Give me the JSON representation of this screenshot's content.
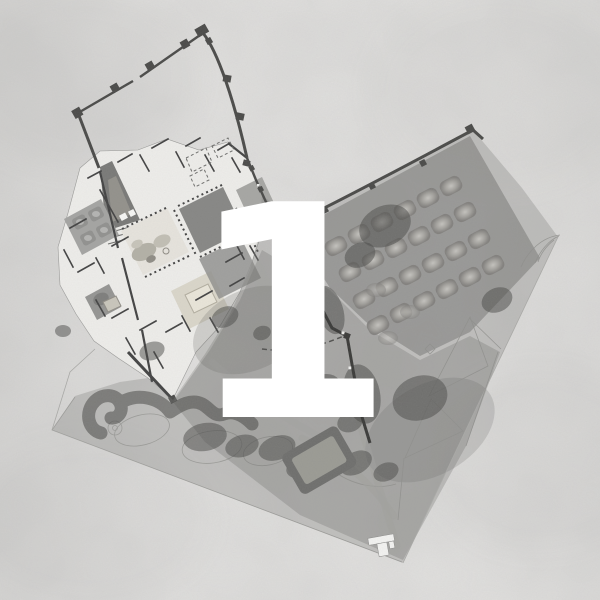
{
  "figure": {
    "number": "1"
  },
  "colors": {
    "paper": "#e7e6e4",
    "ink": "#3d3d3d",
    "wall": "#454543",
    "plan_base": "#f1f0ed",
    "court_dark": "#848482",
    "court_mid": "#a5a5a2",
    "pond_rim": "#6b6b69",
    "pond_water": "#999992",
    "outline": "#a9a9a6",
    "overlay_wash": "#7d7d7a",
    "numeral": "#ffffff"
  },
  "regions": [
    {
      "id": "fortress-enclosure",
      "name": "walled enclosure"
    },
    {
      "id": "palace-complex",
      "name": "palace floor plan"
    },
    {
      "id": "orchard-grid",
      "name": "orchard tree grid"
    },
    {
      "id": "terraced-gardens",
      "name": "terraced gardens"
    },
    {
      "id": "serpentine-tree-walk",
      "name": "tree-lined walk"
    },
    {
      "id": "reservoir-pool",
      "name": "reservoir pool"
    },
    {
      "id": "garden-pavilion",
      "name": "garden pavilion"
    },
    {
      "id": "figure-number",
      "name": "overlay figure number"
    }
  ]
}
